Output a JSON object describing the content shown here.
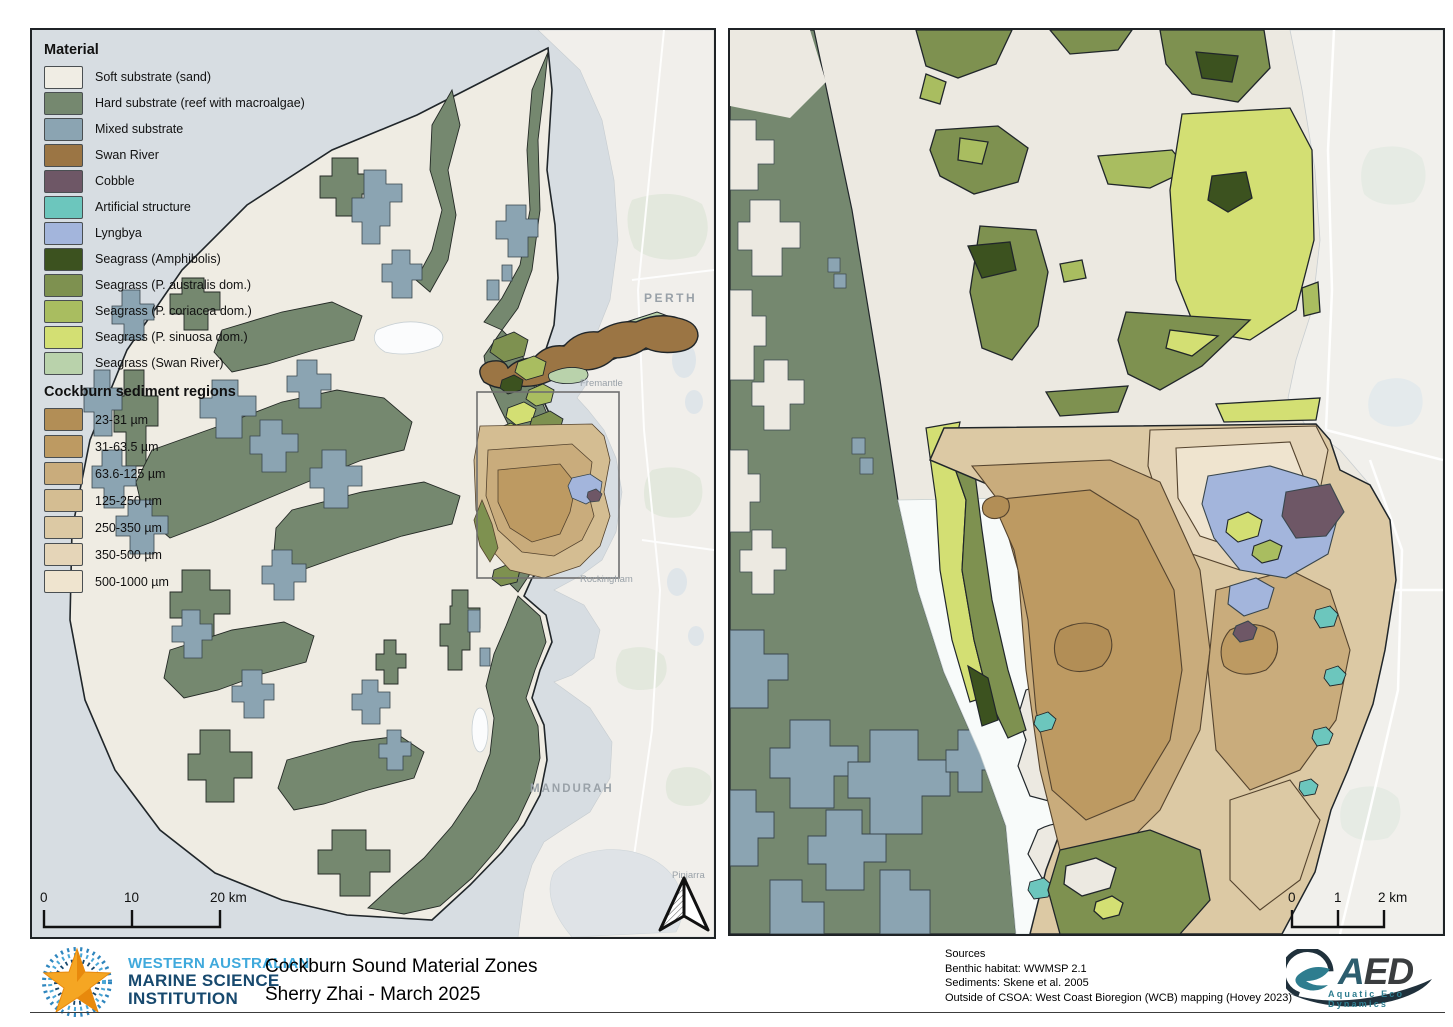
{
  "title_block": {
    "line1": "Cockburn Sound Material Zones",
    "line2": "Sherry Zhai - March 2025"
  },
  "wamsi_logo": {
    "line1": "WESTERN AUSTRALIAN",
    "line2": "MARINE SCIENCE",
    "line3": "INSTITUTION"
  },
  "aed_logo": {
    "acronym_a": "A",
    "acronym_ed": "ED",
    "tagline": "Aquatic Eco Dynamics"
  },
  "sources": {
    "heading": "Sources",
    "lines": [
      "Benthic habitat: WWMSP 2.1",
      "Sediments: Skene et al. 2005",
      "Outside of CSOA: West Coast Bioregion (WCB) mapping (Hovey 2023)"
    ]
  },
  "legend": {
    "material_heading": "Material",
    "material_items": [
      {
        "label": "Soft substrate (sand)",
        "color": "#f0ede4"
      },
      {
        "label": "Hard substrate (reef with macroalgae)",
        "color": "#75886f"
      },
      {
        "label": "Mixed substrate",
        "color": "#8ba4b2"
      },
      {
        "label": "Swan River",
        "color": "#9b7544"
      },
      {
        "label": "Cobble",
        "color": "#6e5766"
      },
      {
        "label": "Artificial structure",
        "color": "#6cc6bd"
      },
      {
        "label": "Lyngbya",
        "color": "#a3b5dc"
      },
      {
        "label": "Seagrass (Amphibolis)",
        "color": "#3c521f"
      },
      {
        "label": "Seagrass (P. australis dom.)",
        "color": "#7e9150"
      },
      {
        "label": "Seagrass (P. coriacea dom.)",
        "color": "#a9bd60"
      },
      {
        "label": "Seagrass (P. sinuosa dom.)",
        "color": "#d3df73"
      },
      {
        "label": "Seagrass (Swan River)",
        "color": "#b9d2ab"
      }
    ],
    "sediment_heading": "Cockburn sediment regions",
    "sediment_items": [
      {
        "label": "23-31 µm",
        "color": "#b28e56"
      },
      {
        "label": "31-63.5 µm",
        "color": "#bd9a62"
      },
      {
        "label": "63.6-125 µm",
        "color": "#c9ac7c"
      },
      {
        "label": "125-250 µm",
        "color": "#d4bd92"
      },
      {
        "label": "250-350 µm",
        "color": "#dcc9a4"
      },
      {
        "label": "350-500 µm",
        "color": "#e5d5b8"
      },
      {
        "label": "500-1000 µm",
        "color": "#efe4cf"
      }
    ]
  },
  "left_map": {
    "scalebar": {
      "t0": "0",
      "t1": "10",
      "t2": "20 km"
    },
    "labels": {
      "perth": "PERTH",
      "fremantle": "Fremantle",
      "rockingham": "Rockingham",
      "mandurah": "MANDURAH",
      "pinjarra": "Pinjarra"
    }
  },
  "right_map": {
    "scalebar": {
      "t0": "0",
      "t1": "1",
      "t2": "2 km"
    }
  },
  "colors": {
    "water": "#d7dde2",
    "basemap_land": "#f1efeb",
    "outline": "#23292c",
    "sediment_contour": "#54432e",
    "wamsi_light_blue": "#3fa9dc",
    "wamsi_navy": "#17496e",
    "aed_teal": "#2e7d8f"
  }
}
